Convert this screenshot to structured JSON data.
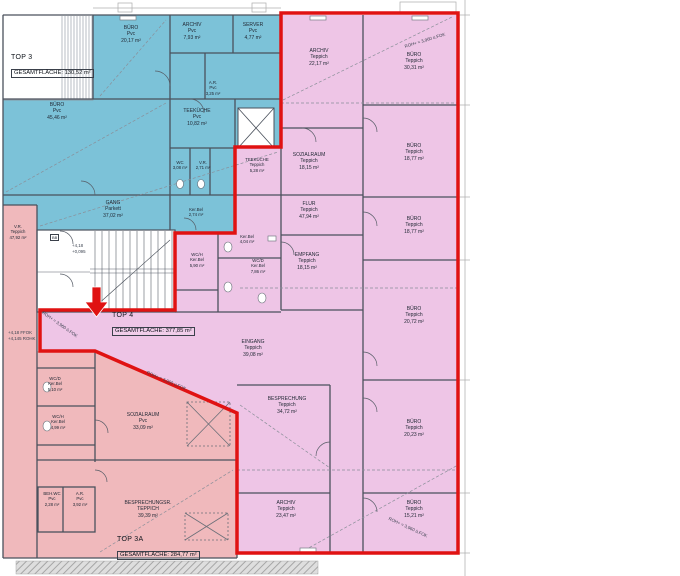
{
  "titles": {
    "top3": {
      "name": "TOP 3",
      "area_label": "GESAMTFLÄCHE: 130,52 m²"
    },
    "top4": {
      "name": "TOP 4",
      "area_label": "GESAMTFLÄCHE: 377,85 m²"
    },
    "top3a": {
      "name": "TOP 3A",
      "area_label": "GESAMTFLÄCHE: 284,77 m²"
    }
  },
  "rooms": {
    "buero_2017": {
      "name": "BÜRO",
      "floor": "Pvc",
      "area": "20,17 m²"
    },
    "archiv_793": {
      "name": "ARCHIV",
      "floor": "Pvc",
      "area": "7,93 m²"
    },
    "server_477": {
      "name": "SERVER",
      "floor": "Pvc",
      "area": "4,77 m²"
    },
    "ar_325": {
      "name": "A.R.",
      "floor": "Pvc",
      "area": "3,25 m²"
    },
    "teekueche_1082": {
      "name": "TEEKÜCHE",
      "floor": "Pvc",
      "area": "10,82 m²"
    },
    "buero_4546": {
      "name": "BÜRO",
      "floor": "Pvc",
      "area": "45,46 m²"
    },
    "wc_308": {
      "name": "WC",
      "floor": "",
      "area": "3,08 m²"
    },
    "vr_271": {
      "name": "V.R.",
      "floor": "",
      "area": "2,71 m²"
    },
    "wc_274": {
      "name": "",
      "floor": "Ker.Bel",
      "area": "2,74 m²"
    },
    "gang_3702": {
      "name": "GANG",
      "floor": "Parkett",
      "area": "37,02 m²"
    },
    "archiv_2217": {
      "name": "ARCHIV",
      "floor": "Teppich",
      "area": "22,17 m²"
    },
    "buero_3031": {
      "name": "BÜRO",
      "floor": "Teppich",
      "area": "30,31 m²"
    },
    "sozialraum_1815": {
      "name": "SOZIALRAUM",
      "floor": "Teppich",
      "area": "18,15 m²"
    },
    "teekueche_528": {
      "name": "TEEKÜCHE",
      "floor": "Teppich",
      "area": "5,28 m²"
    },
    "flur_4794": {
      "name": "FLUR",
      "floor": "Teppich",
      "area": "47,94 m²"
    },
    "buero_1877a": {
      "name": "BÜRO",
      "floor": "Teppich",
      "area": "18,77 m²"
    },
    "buero_1877b": {
      "name": "BÜRO",
      "floor": "Teppich",
      "area": "18,77 m²"
    },
    "buero_2072": {
      "name": "BÜRO",
      "floor": "Teppich",
      "area": "20,72 m²"
    },
    "buero_2023": {
      "name": "BÜRO",
      "floor": "Teppich",
      "area": "20,23 m²"
    },
    "buero_1521": {
      "name": "BÜRO",
      "floor": "Teppich",
      "area": "15,21 m²"
    },
    "empfang_1815": {
      "name": "EMPFANG",
      "floor": "Teppich",
      "area": "18,15 m²"
    },
    "eingang_3908": {
      "name": "EINGANG",
      "floor": "Teppich",
      "area": "39,08 m²"
    },
    "besprechung_3472": {
      "name": "BESPRECHUNG",
      "floor": "Teppich",
      "area": "34,72 m²"
    },
    "archiv_2347": {
      "name": "ARCHIV",
      "floor": "Teppich",
      "area": "23,47 m²"
    },
    "wc_h_590": {
      "name": "WC/H",
      "floor": "Ker.Bel",
      "area": "5,90 m²"
    },
    "vr_404": {
      "name": "",
      "floor": "Ker.Bel",
      "area": "4,04 m²"
    },
    "wc_d_786": {
      "name": "WC/D",
      "floor": "Ker.Bel",
      "area": "7,86 m²"
    },
    "vr_4792": {
      "name": "V.R.",
      "floor": "Teppich",
      "area": "47,92 m²"
    },
    "wc_d_510": {
      "name": "WC/D",
      "floor": "Ker.Bel",
      "area": "5,10 m²"
    },
    "wc_h_499": {
      "name": "WC/H",
      "floor": "Ker.Bel",
      "area": "4,99 m²"
    },
    "sozialraum_3309": {
      "name": "SOZIALRAUM",
      "floor": "Pvc",
      "area": "33,09 m²"
    },
    "beh_wc_228": {
      "name": "BEH.WC",
      "floor": "Pvc",
      "area": "2,28 m²"
    },
    "ar_392": {
      "name": "A.R.",
      "floor": "Pvc",
      "area": "3,92 m²"
    },
    "besprechungsr_3939": {
      "name": "BESPRECHUNGSR.",
      "floor": "TEPPICH",
      "area": "39,39 m²"
    }
  },
  "annotations": {
    "roh": "ROH+ = 3,960 ü.FOK",
    "stair_level_top": "+4,18",
    "stair_level_bottom": "+0,095",
    "ffok_line1": "+4,18 FFOK",
    "ffok_line2": "+4,145 ROHK",
    "bb": "BB"
  },
  "colors": {
    "top3_fill": "#7cc2d8",
    "top3a_fill": "#f0b9bc",
    "top4_fill": "#eec5e6",
    "outline_red": "#e01212"
  }
}
